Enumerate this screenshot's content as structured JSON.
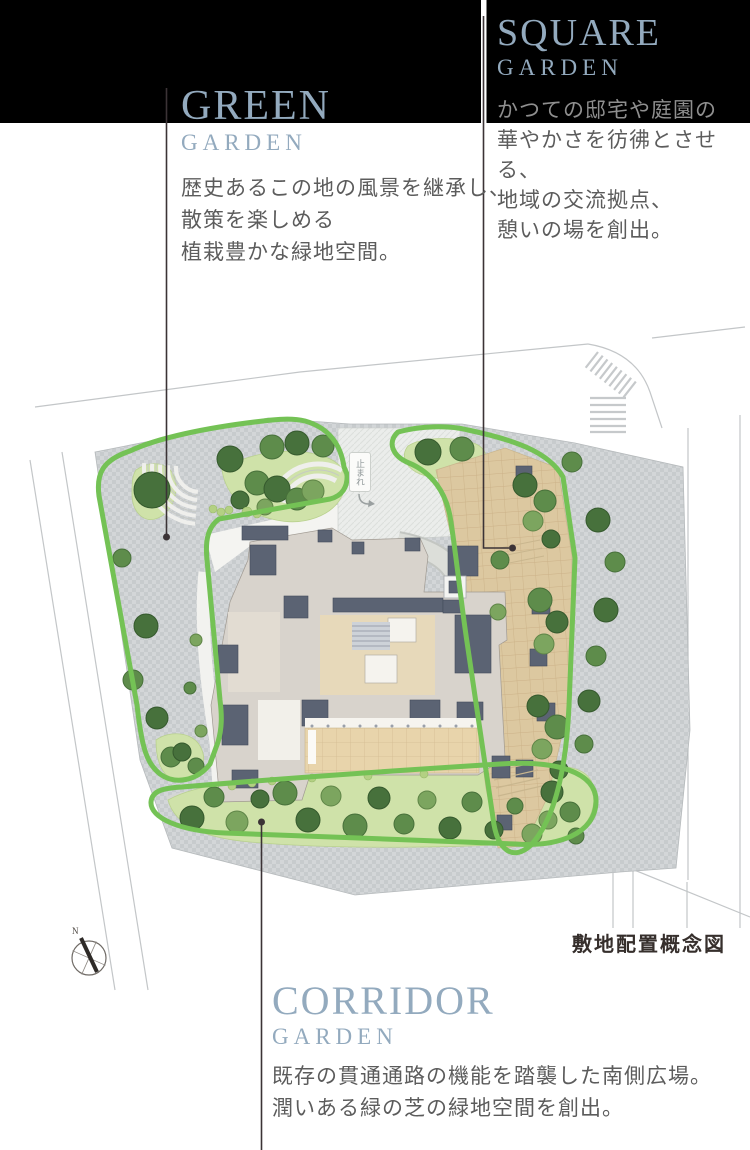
{
  "gardens": {
    "green": {
      "title": "GREEN",
      "subtitle": "GARDEN",
      "desc_lines": [
        "歴史あるこの地の風景を継承し、",
        "散策を楽しめる",
        "植栽豊かな緑地空間。"
      ]
    },
    "square": {
      "title": "SQUARE",
      "subtitle": "GARDEN",
      "desc_lines": [
        "かつての邸宅や庭園の",
        "華やかさを彷彿とさせる、",
        "地域の交流拠点、",
        "憩いの場を創出。"
      ]
    },
    "corridor": {
      "title": "CORRIDOR",
      "subtitle": "GARDEN",
      "desc_lines": [
        "既存の貫通通路の機能を踏襲した南側広場。",
        "潤いある緑の芝の緑地空間を創出。"
      ]
    }
  },
  "map": {
    "caption": "敷地配置概念図",
    "road_marking": "止まれ",
    "compass_letter": "N"
  },
  "colors": {
    "banner_black": "#000000",
    "title_blue": "#93aabe",
    "body_text": "#5c5c5c",
    "loop_green": "#74c255",
    "plaza_tan": "#dcc8a0",
    "paver_grey": "#cdd1d3",
    "lawn_green": "#cfe2a9",
    "roof_slate": "#5b6373"
  }
}
